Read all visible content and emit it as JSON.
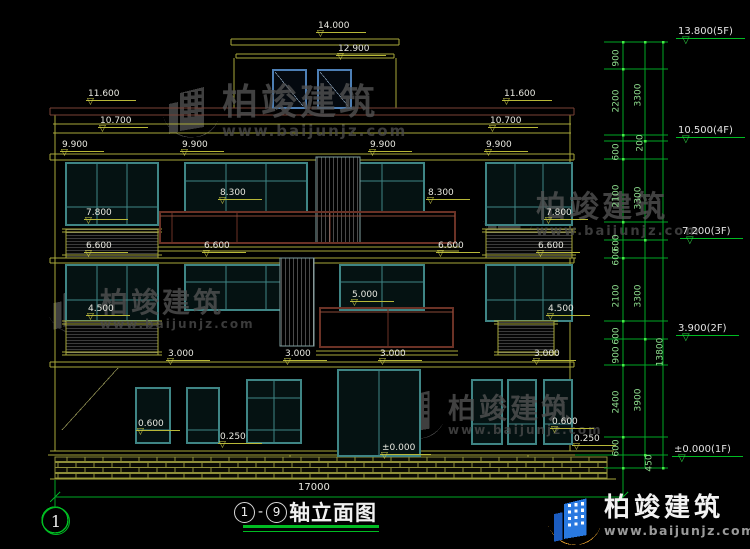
{
  "drawing": {
    "title_axis_start": "1",
    "title_axis_end": "9",
    "title_dash": "-",
    "title_text": "轴立面图",
    "axis_bubble": "1",
    "overall_width": "17000"
  },
  "watermark": {
    "brand": "柏竣建筑",
    "url": "www.baijunjz.com"
  },
  "level_labels": [
    {
      "t": "14.000",
      "x": 316,
      "y": 22
    },
    {
      "t": "12.900",
      "x": 336,
      "y": 45
    },
    {
      "t": "11.600",
      "x": 86,
      "y": 90
    },
    {
      "t": "11.600",
      "x": 502,
      "y": 90
    },
    {
      "t": "10.700",
      "x": 98,
      "y": 117
    },
    {
      "t": "10.700",
      "x": 488,
      "y": 117
    },
    {
      "t": "9.900",
      "x": 60,
      "y": 141
    },
    {
      "t": "9.900",
      "x": 180,
      "y": 141
    },
    {
      "t": "9.900",
      "x": 368,
      "y": 141
    },
    {
      "t": "9.900",
      "x": 484,
      "y": 141
    },
    {
      "t": "8.300",
      "x": 218,
      "y": 189
    },
    {
      "t": "8.300",
      "x": 426,
      "y": 189
    },
    {
      "t": "7.800",
      "x": 84,
      "y": 209
    },
    {
      "t": "7.800",
      "x": 544,
      "y": 209
    },
    {
      "t": "6.600",
      "x": 84,
      "y": 242
    },
    {
      "t": "6.600",
      "x": 202,
      "y": 242
    },
    {
      "t": "6.600",
      "x": 436,
      "y": 242
    },
    {
      "t": "6.600",
      "x": 536,
      "y": 242
    },
    {
      "t": "5.000",
      "x": 350,
      "y": 291
    },
    {
      "t": "4.500",
      "x": 86,
      "y": 305
    },
    {
      "t": "4.500",
      "x": 546,
      "y": 305
    },
    {
      "t": "3.000",
      "x": 166,
      "y": 350
    },
    {
      "t": "3.000",
      "x": 283,
      "y": 350
    },
    {
      "t": "3.000",
      "x": 378,
      "y": 350
    },
    {
      "t": "3.000",
      "x": 532,
      "y": 350
    },
    {
      "t": "0.600",
      "x": 136,
      "y": 420
    },
    {
      "t": "0.600",
      "x": 550,
      "y": 418
    },
    {
      "t": "0.250",
      "x": 218,
      "y": 433
    },
    {
      "t": "0.250",
      "x": 572,
      "y": 435
    },
    {
      "t": "±0.000",
      "x": 380,
      "y": 444
    }
  ],
  "ladder_labels": [
    {
      "t": "900",
      "x": 617,
      "y": 58
    },
    {
      "t": "2200",
      "x": 617,
      "y": 101
    },
    {
      "t": "3300",
      "x": 639,
      "y": 95
    },
    {
      "t": "200",
      "x": 641,
      "y": 143
    },
    {
      "t": "600",
      "x": 617,
      "y": 152
    },
    {
      "t": "2100",
      "x": 617,
      "y": 196
    },
    {
      "t": "3300",
      "x": 639,
      "y": 198
    },
    {
      "t": "600",
      "x": 617,
      "y": 243
    },
    {
      "t": "600",
      "x": 617,
      "y": 257
    },
    {
      "t": "2100",
      "x": 617,
      "y": 296
    },
    {
      "t": "3300",
      "x": 639,
      "y": 296
    },
    {
      "t": "600",
      "x": 617,
      "y": 336
    },
    {
      "t": "900",
      "x": 617,
      "y": 355
    },
    {
      "t": "2400",
      "x": 617,
      "y": 402
    },
    {
      "t": "3900",
      "x": 639,
      "y": 400
    },
    {
      "t": "600",
      "x": 617,
      "y": 448
    },
    {
      "t": "450",
      "x": 650,
      "y": 463
    },
    {
      "t": "13800",
      "x": 661,
      "y": 352
    }
  ],
  "floor_markers": [
    {
      "t": "13.800(5F)",
      "x": 676,
      "y": 26
    },
    {
      "t": "10.500(4F)",
      "x": 676,
      "y": 125
    },
    {
      "t": "7.200(3F)",
      "x": 680,
      "y": 226
    },
    {
      "t": "3.900(2F)",
      "x": 676,
      "y": 323
    },
    {
      "t": "±0.000(1F)",
      "x": 672,
      "y": 444
    }
  ],
  "colors": {
    "line_yellow": "#a8a83a",
    "window_teal": "#3f8585",
    "railing_brown": "#6b3226",
    "dim_green": "#00a825",
    "text_white": "#e8e8e0",
    "tower_blue": "#4d7fb5",
    "logo_blue": "#2979e0",
    "logo_gold": "#f0a830"
  }
}
